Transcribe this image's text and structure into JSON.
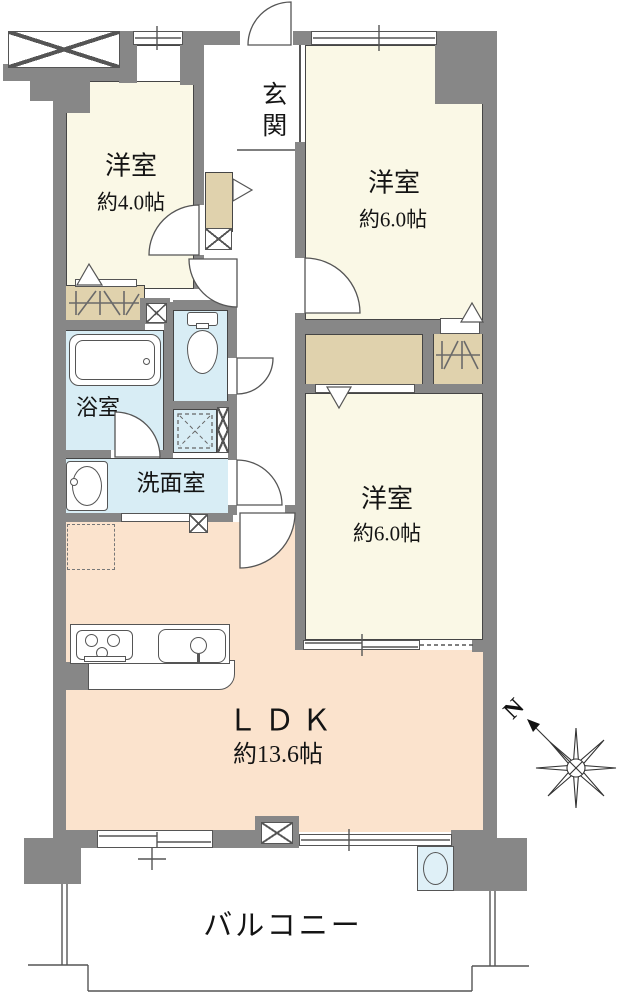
{
  "rooms": {
    "entrance": {
      "label": "玄関"
    },
    "bedroom_small": {
      "label": "洋室",
      "size": "約4.0帖"
    },
    "bedroom_top": {
      "label": "洋室",
      "size": "約6.0帖"
    },
    "bedroom_middle": {
      "label": "洋室",
      "size": "約6.0帖"
    },
    "bath": {
      "label": "浴室"
    },
    "washroom": {
      "label": "洗面室"
    },
    "ldk": {
      "label": "ＬＤＫ",
      "size": "約13.6帖"
    },
    "balcony": {
      "label": "バルコニー"
    }
  },
  "compass": {
    "north_label": "N"
  },
  "colors": {
    "wall": "#878787",
    "room_floor": "#faf8e6",
    "ldk_floor": "#fbe3cd",
    "wet_floor": "#d8edf5",
    "closet": "#e0d2ad",
    "water_heater": "#dff0f7",
    "line": "#555555"
  }
}
